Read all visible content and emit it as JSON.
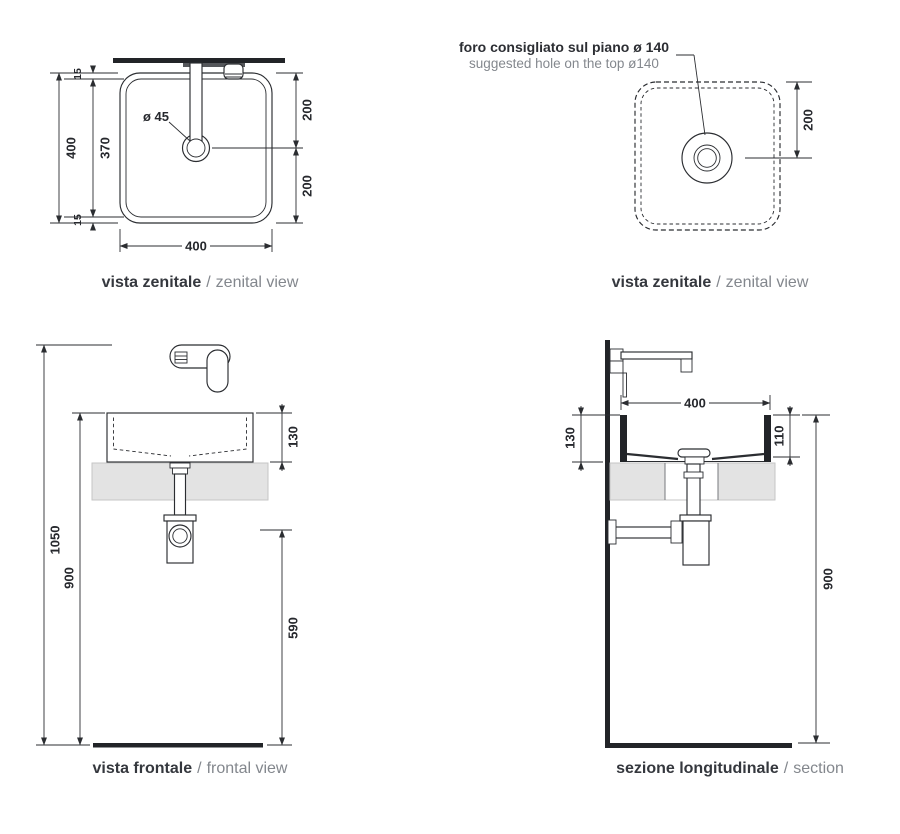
{
  "drawing": {
    "views": {
      "top_view_tap": {
        "caption_it": "vista zenitale",
        "caption_sep": "/",
        "caption_en": "zenital view",
        "dims": {
          "overall_width_left": "400",
          "inner_width": "370",
          "offset_top": "15",
          "offset_bottom": "15",
          "right_upper": "200",
          "right_lower": "200",
          "overall_width_bottom": "400",
          "drain_diameter": "ø 45"
        }
      },
      "top_view_hole": {
        "caption_it": "vista zenitale",
        "caption_sep": "/",
        "caption_en": "zenital view",
        "note_it": "foro consigliato sul piano ø 140",
        "note_en": "suggested hole on the top ø140",
        "dims": {
          "hole_offset": "200"
        }
      },
      "front_view": {
        "caption_it": "vista frontale",
        "caption_sep": "/",
        "caption_en": "frontal view",
        "dims": {
          "overall_height": "1050",
          "rim_height": "900",
          "basin_height": "130",
          "trap_height": "590"
        }
      },
      "section_view": {
        "caption_it": "sezione longitudinale",
        "caption_sep": "/",
        "caption_en": "section",
        "dims": {
          "basin_width": "400",
          "basin_height": "130",
          "inner_depth": "110",
          "rim_height": "900"
        }
      }
    },
    "colors": {
      "line": "#2b2d31",
      "dim_text": "#26282d",
      "caption_it": "#35383e",
      "caption_en": "#83878d",
      "counter_fill": "#e3e3e3"
    }
  }
}
